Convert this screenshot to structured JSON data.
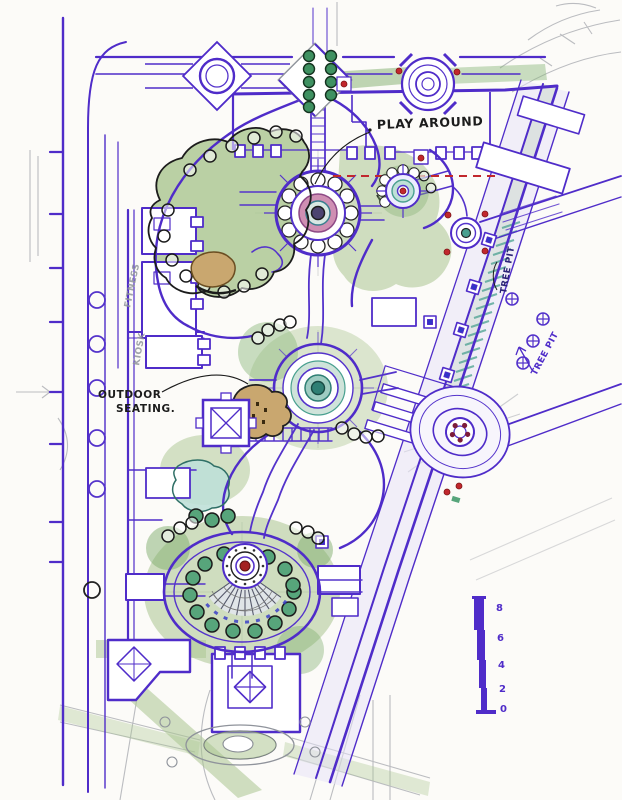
{
  "document": {
    "type": "hand-drawn landscape site plan sketch",
    "medium": "ink, marker wash and pencil"
  },
  "annotations": {
    "play_around": "PLAY AROUND",
    "outdoor_seating_line1": "OUTDOOR",
    "outdoor_seating_line2": "SEATING.",
    "tree_pit_upper": "TREE PIT",
    "tree_pit_lower": "TREE PIT",
    "fitness": "FITNESS",
    "kiosk": "KIOSK"
  },
  "scale_bar": {
    "labels": [
      "8",
      "6",
      "4",
      "2",
      "0"
    ]
  },
  "colors": {
    "ink_purple": "#4f2cc9",
    "ink_blue": "#3136c8",
    "green_wash": "#a9c58f",
    "teal": "#49a08f",
    "magenta": "#c77ba6",
    "red": "#c1272d",
    "tan": "#c9a76f",
    "pencil": "#8f939b",
    "paper": "#fcfbf8"
  }
}
